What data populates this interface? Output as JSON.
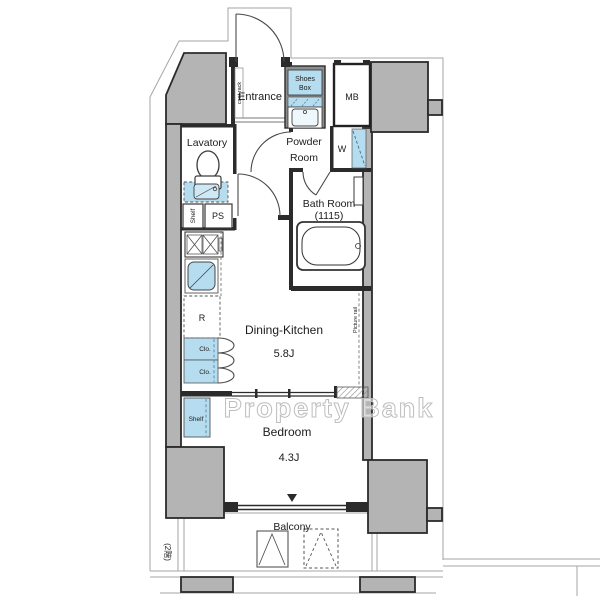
{
  "plan": {
    "watermark": "Property Bank",
    "floor_note": "(2階)",
    "rooms": {
      "entrance": {
        "label": "Entrance"
      },
      "coat_rack": {
        "label": "coat rack"
      },
      "shoes_box": {
        "line1": "Shoes",
        "line2": "Box"
      },
      "meter_box": {
        "label": "MB"
      },
      "lavatory": {
        "label": "Lavatory"
      },
      "lavatory_shelf": {
        "label": "Shelf"
      },
      "pipe_space": {
        "label": "PS"
      },
      "powder_room": {
        "line1": "Powder",
        "line2": "Room"
      },
      "washer": {
        "label": "W"
      },
      "bath_room": {
        "line1": "Bath Room",
        "line2": "(1115)"
      },
      "dining_kitchen": {
        "label": "Dining-Kitchen",
        "size": "5.8J"
      },
      "refrigerator": {
        "label": "R"
      },
      "closet1": {
        "label": "Clo."
      },
      "closet2": {
        "label": "Clo."
      },
      "bedroom_shelf": {
        "label": "Shelf"
      },
      "bedroom": {
        "label": "Bedroom",
        "size": "4.3J"
      },
      "balcony": {
        "label": "Balcony"
      },
      "picture_rail": {
        "label": "Picture rail"
      }
    },
    "colors": {
      "wall_gray": "#b4b4b4",
      "dark_gray": "#8d8d8d",
      "fixture_blue": "#b5ddef",
      "line_dark": "#2b2b2b"
    }
  }
}
